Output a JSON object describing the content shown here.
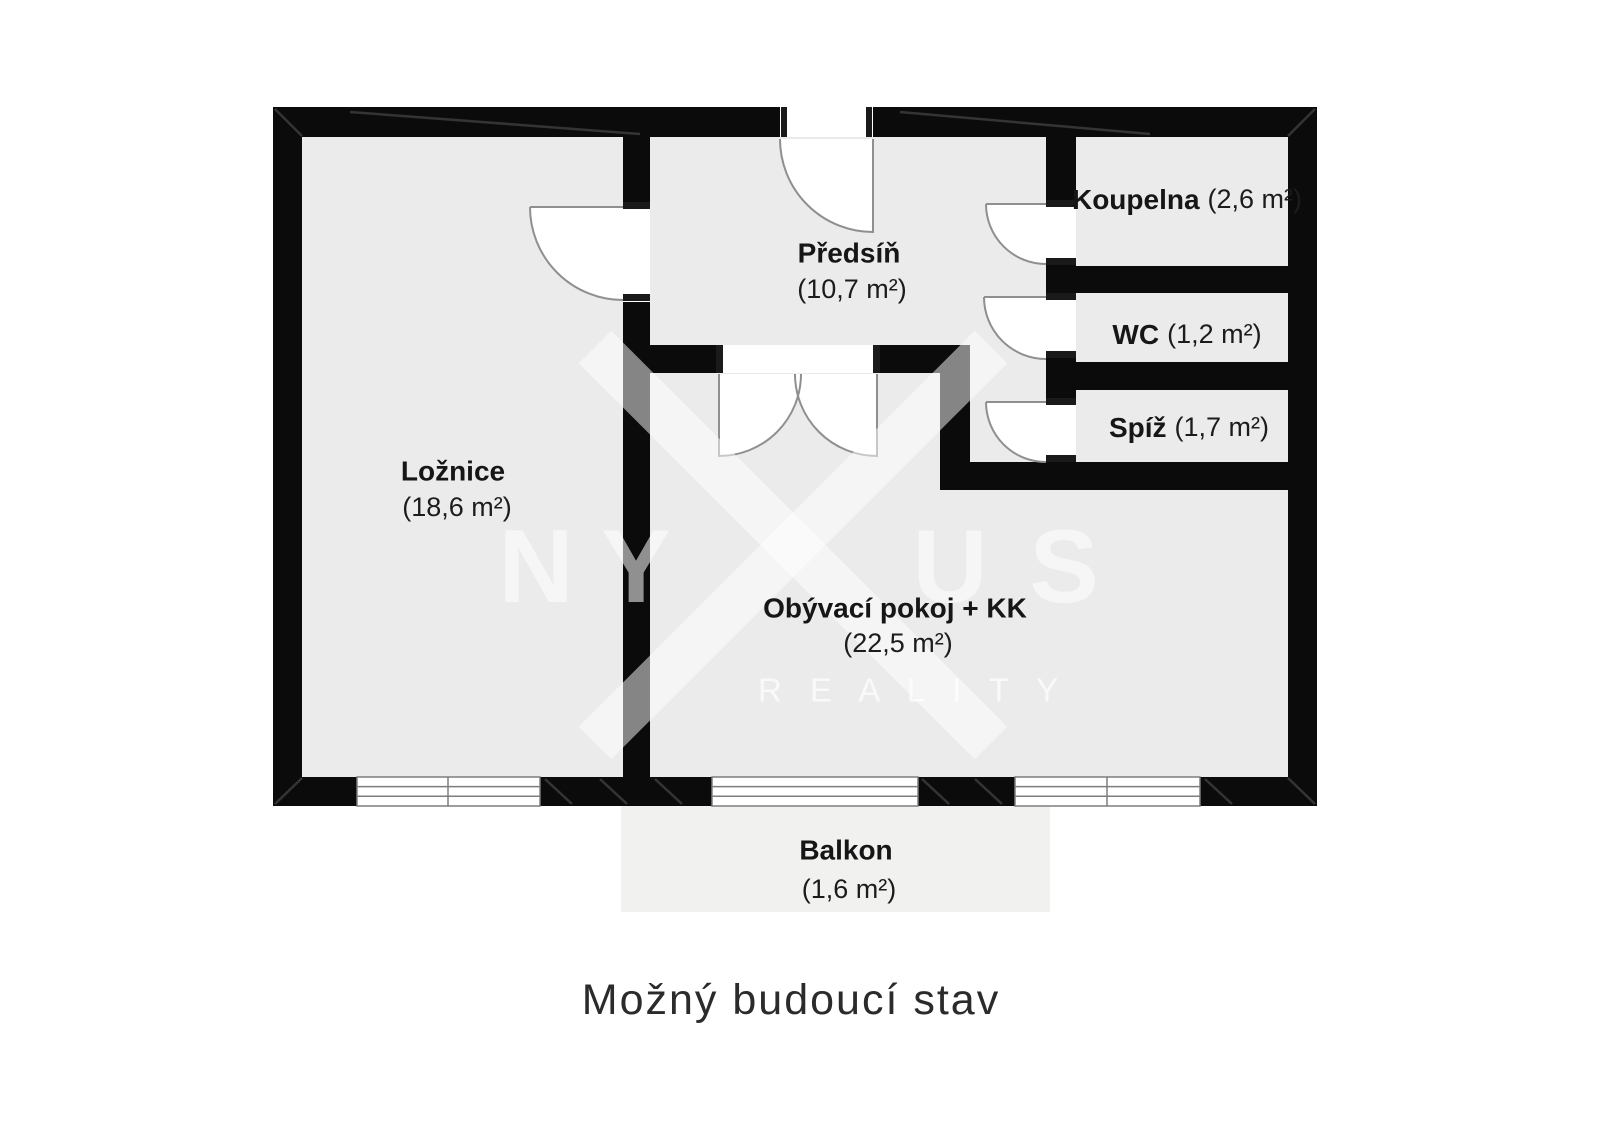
{
  "caption": "Možný budoucí stav",
  "watermark": {
    "letter_n": "N",
    "letter_y": "Y",
    "letter_u": "U",
    "letter_s": "S",
    "reality": "R E A L I T Y"
  },
  "rooms": {
    "loznice": {
      "name": "Ložnice",
      "area": "(18,6 m²)"
    },
    "predsin": {
      "name": "Předsíň",
      "area": "(10,7 m²)"
    },
    "koupelna": {
      "name": "Koupelna",
      "area": "(2,6 m²)"
    },
    "wc": {
      "name": "WC",
      "area": "(1,2 m²)"
    },
    "spiz": {
      "name": "Spíž",
      "area": "(1,7 m²)"
    },
    "obyvaci": {
      "name": "Obývací pokoj + KK",
      "area": "(22,5 m²)"
    },
    "balkon": {
      "name": "Balkon",
      "area": "(1,6 m²)"
    }
  },
  "colors": {
    "wall": "#0b0b0b",
    "room_fill": "#ebebeb",
    "balcony_fill": "#f1f1f0",
    "label_text": "#161616",
    "caption_text": "#2b2b2b",
    "watermark": "rgba(255,255,255,0.55)"
  }
}
